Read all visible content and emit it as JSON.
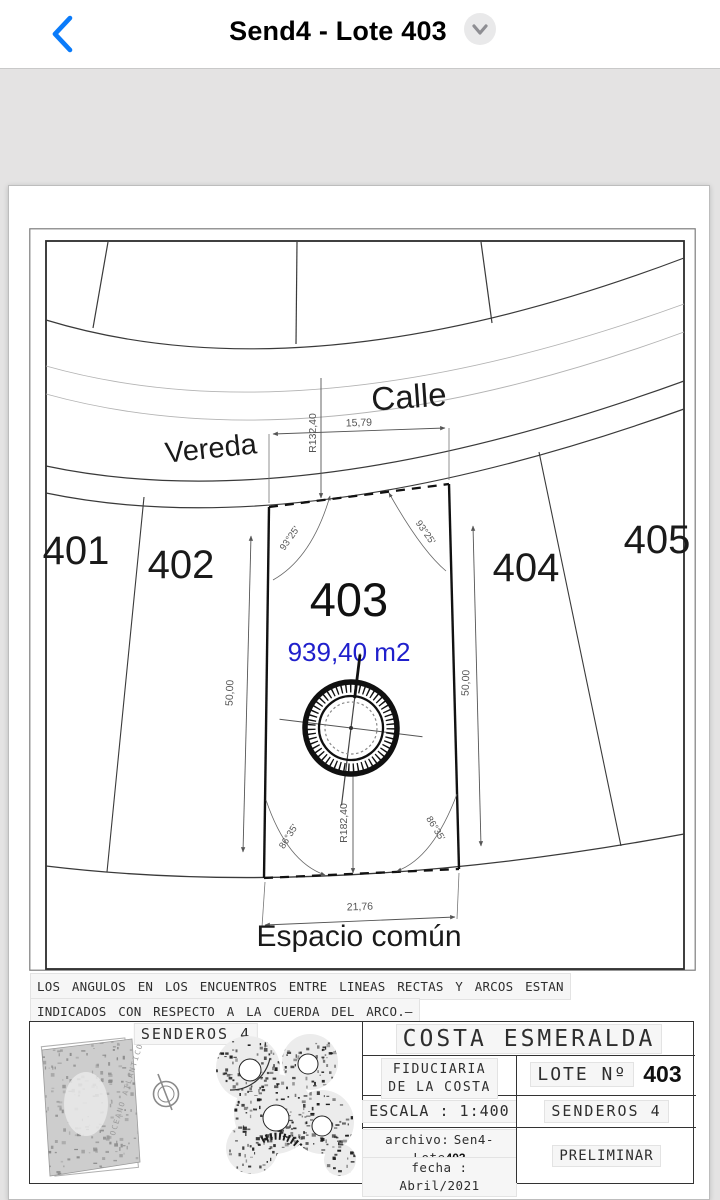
{
  "nav": {
    "title": "Send4 - Lote 403",
    "back_icon": "chevron-left",
    "expand_icon": "chevron-down"
  },
  "plan": {
    "street_label": "Calle",
    "sidewalk_label": "Vereda",
    "common_space_label": "Espacio común",
    "lot_labels": {
      "l401": "401",
      "l402": "402",
      "l403": "403",
      "l404": "404",
      "l405": "405"
    },
    "center_lot": {
      "area": "939,40 m2",
      "area_color": "#2020cc"
    },
    "dimensions": {
      "front_width": "15,79",
      "front_radius": "R132,40",
      "left_depth": "50,00",
      "right_depth": "50,00",
      "rear_width": "21,76",
      "rear_radius": "R182,40",
      "front_angle_left": "93°25'",
      "front_angle_right": "93°25'",
      "rear_angle_left": "86°35'",
      "rear_angle_right": "86°35'"
    }
  },
  "note": {
    "line1": "LOS ANGULOS EN LOS ENCUENTROS ENTRE LINEAS RECTAS Y ARCOS ESTAN",
    "line2": "INDICADOS CON RESPECTO A LA CUERDA DEL ARCO.–"
  },
  "title_block": {
    "sector_label": "SENDEROS 4",
    "ocean_label": "OCEANO ATLANTICO",
    "project": "COSTA ESMERALDA",
    "developer_line1": "FIDUCIARIA",
    "developer_line2": "DE LA COSTA",
    "lote_label": "LOTE Nº",
    "lote_number": "403",
    "escala": "ESCALA : 1:400",
    "sector": "SENDEROS 4",
    "archivo_label": "archivo:",
    "archivo_value": "Sen4-Lote",
    "archivo_number": "403",
    "fecha": "fecha : Abril/2021",
    "status": "PRELIMINAR"
  }
}
